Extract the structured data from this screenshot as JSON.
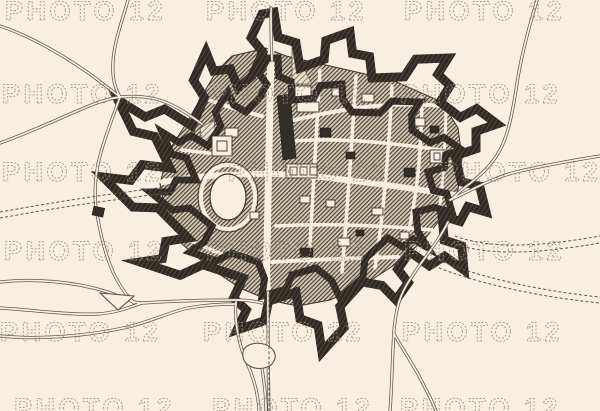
{
  "figure": {
    "title": "Antique engraved plan of a fortified town with star-shaped bastions",
    "kind": "map-engraving",
    "visible_text_other_than_watermark": ""
  },
  "watermark": {
    "text": "PHOTO 12",
    "color": "#9c9383",
    "tiles": [
      {
        "x": 5,
        "y": 20
      },
      {
        "x": 206,
        "y": 20
      },
      {
        "x": 404,
        "y": 20
      },
      {
        "x": 2,
        "y": 103
      },
      {
        "x": 208,
        "y": 103
      },
      {
        "x": 400,
        "y": 103
      },
      {
        "x": 2,
        "y": 181
      },
      {
        "x": 228,
        "y": 181
      },
      {
        "x": 440,
        "y": 181
      },
      {
        "x": 4,
        "y": 260
      },
      {
        "x": 206,
        "y": 260
      },
      {
        "x": 404,
        "y": 260
      },
      {
        "x": 0,
        "y": 341
      },
      {
        "x": 203,
        "y": 341
      },
      {
        "x": 402,
        "y": 341
      },
      {
        "x": 14,
        "y": 417
      },
      {
        "x": 212,
        "y": 417
      },
      {
        "x": 400,
        "y": 417
      }
    ]
  },
  "palette": {
    "paper": "#f7f0e1",
    "ink": "#2b2620",
    "wall": "#2e2923",
    "wall_line": "#564e41",
    "road": "#5c564d",
    "hatch_base": "#d8cdb8",
    "hatch_line": "#4a4336",
    "watermark": "#9c9383"
  }
}
